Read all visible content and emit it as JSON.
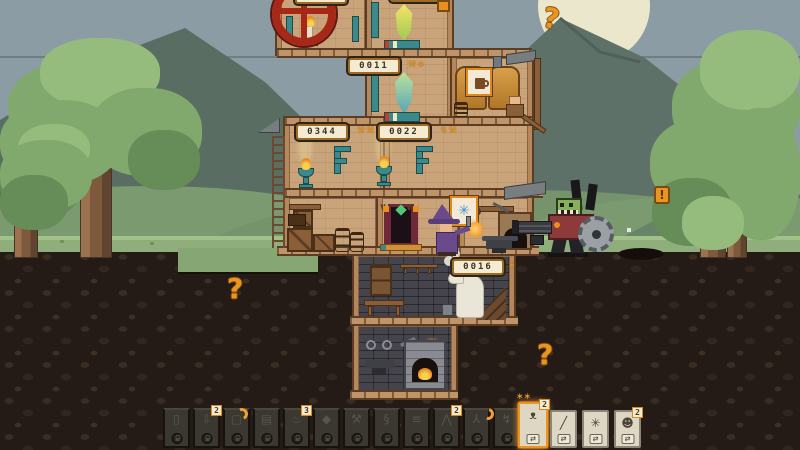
{
  "colors": {
    "accent_orange": "#e8961e",
    "cream": "#f2ead2",
    "wall_tan": "#c9a47b",
    "sky": "#8c9ca4",
    "underground": "#241b16",
    "teal_pipe": "#3a8a8c",
    "wheel_red": "#a82818"
  },
  "hud": {
    "counters": {
      "crystal": {
        "value": "0011",
        "icons": "⚒∗"
      },
      "workshop_left": {
        "value": "0344",
        "icons": "⚒⚒"
      },
      "workshop_right": {
        "value": "0022",
        "icons": "↯⚒"
      },
      "basement": {
        "value": "0016",
        "icons": "∗"
      },
      "top_left_partial": {
        "value": ""
      },
      "top_right_partial": {
        "value": ""
      }
    },
    "question_marks": [
      "?",
      "?",
      "?"
    ],
    "exclamation": "!",
    "wall_marks": [
      "∨",
      "∨"
    ]
  },
  "craft_card": {
    "icon": "blue-sparks-icon",
    "glyph": "✳"
  },
  "brewery_card": {
    "icon": "mug-icon"
  },
  "hotbar": {
    "slots": [
      {
        "name": "jar-slot",
        "glyph": "▯",
        "badge": ""
      },
      {
        "name": "deposit-slot",
        "glyph": "⇩",
        "badge": "2"
      },
      {
        "name": "frame-slot",
        "glyph": "▢",
        "badge": ""
      },
      {
        "name": "planter-crate-slot",
        "glyph": "▤",
        "badge": ""
      },
      {
        "name": "tankard-slot",
        "glyph": "♨",
        "badge": "3"
      },
      {
        "name": "gem-slot",
        "glyph": "◆",
        "badge": ""
      },
      {
        "name": "hammer-slot",
        "glyph": "⚒",
        "badge": ""
      },
      {
        "name": "hook-slot",
        "glyph": "§",
        "badge": ""
      },
      {
        "name": "planks-slot",
        "glyph": "≡",
        "badge": ""
      },
      {
        "name": "pickaxe-slot",
        "glyph": "⋀",
        "badge": "2"
      },
      {
        "name": "axe-slot",
        "glyph": "⅄",
        "badge": ""
      },
      {
        "name": "bolt-slot",
        "glyph": "↯",
        "badge": ""
      }
    ],
    "cards": [
      {
        "name": "beast-card",
        "glyph": "ᴥ",
        "badge": "2",
        "selected": true,
        "action": "⇄"
      },
      {
        "name": "slash-spark-card",
        "glyph": "╱",
        "badge": "",
        "selected": false,
        "action": "⇄"
      },
      {
        "name": "burst-spark-card",
        "glyph": "✳",
        "badge": "",
        "selected": false,
        "action": "⇄"
      },
      {
        "name": "monkey-card",
        "glyph": "☻",
        "badge": "2",
        "selected": false,
        "action": "⇄"
      }
    ]
  }
}
